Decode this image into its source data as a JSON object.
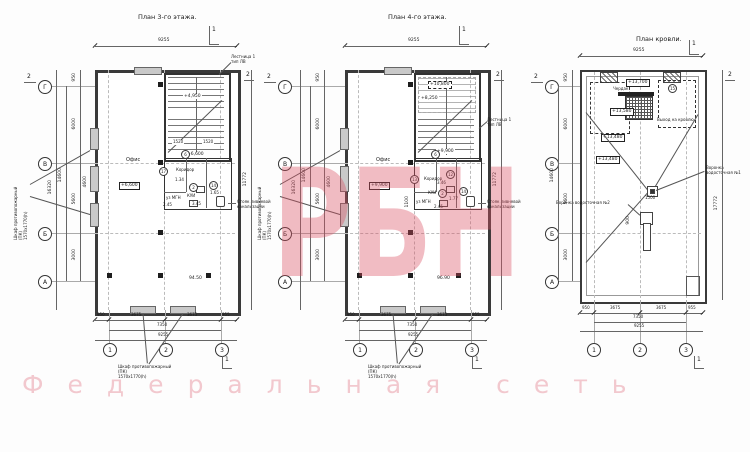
{
  "watermark": {
    "big": "РБН",
    "sub": "Федеральная сеть",
    "color": "#db5062"
  },
  "common": {
    "top_dim": "9255",
    "right_dim": "11772",
    "bs1": "950",
    "bs2": "3675",
    "bs3": "3675",
    "bs4": "955",
    "bt1": "7350",
    "bt2": "9255",
    "ls_950": "950",
    "ls_6000": "6000",
    "ls_4600": "4600",
    "ls_5600": "5600",
    "ls_3000": "3000",
    "lt_14600": "14600",
    "lt_16320": "16320",
    "ax_g": "Г",
    "ax_v": "В",
    "ax_b": "Б",
    "ax_a": "А",
    "ax1": "1",
    "ax2": "2",
    "ax3": "3",
    "mk1": "1",
    "mk2": "2",
    "stair1": "Лестница 1",
    "stair2": "тип ЛВ",
    "riser1": "Стояк ливневой",
    "riser2": "канализации",
    "cab1": "Шкаф противопожарный",
    "cab2": "(ПК)",
    "cab3": "1570х1770(h)"
  },
  "plans": {
    "p1": {
      "title": "План 3-го этажа.",
      "room": "Офис",
      "area": "94.50",
      "box_level": "+6,600",
      "landing": "+4,950",
      "exit_level": "+6,600",
      "tread1": "1520",
      "tread2": "1520",
      "corridor": "Коридор",
      "wc_a": "уз МГН",
      "wc_b": "КУИ",
      "n1": "1.34",
      "n2": "2.45",
      "n3": "3.45",
      "n4": "1.65",
      "r1": "6",
      "r2": "17",
      "r3": "2",
      "r4": "14"
    },
    "p2": {
      "title": "План 4-го этажа.",
      "room": "Офис",
      "area": "96.90",
      "box_level": "+9,900",
      "upper_level": "+10,800",
      "landing": "+8,250",
      "exit_level": "+9,900",
      "corridor": "Коридор",
      "wc_a": "уз МГН",
      "wc_b": "КУИ",
      "n1": "1100",
      "n2": "2.45",
      "n3": "3.46",
      "n4": "1.77",
      "r1": "6",
      "r2": "13",
      "r3": "12",
      "r4": "2",
      "r5": "14"
    },
    "p3": {
      "title": "План кровли.",
      "attic": "Чердак",
      "exit": "Выход на кровлю",
      "lv_top": "+13,700",
      "lv_a": "+13,580",
      "lv_b": "+13,480",
      "lv_c": "+13,480",
      "drain1a": "Воронка",
      "drain1b": "водосточная №1",
      "drain2": "Воронка водосточная №2",
      "n1": "1500",
      "n2": "900",
      "ref": "15",
      "right_dim": "17772"
    }
  }
}
